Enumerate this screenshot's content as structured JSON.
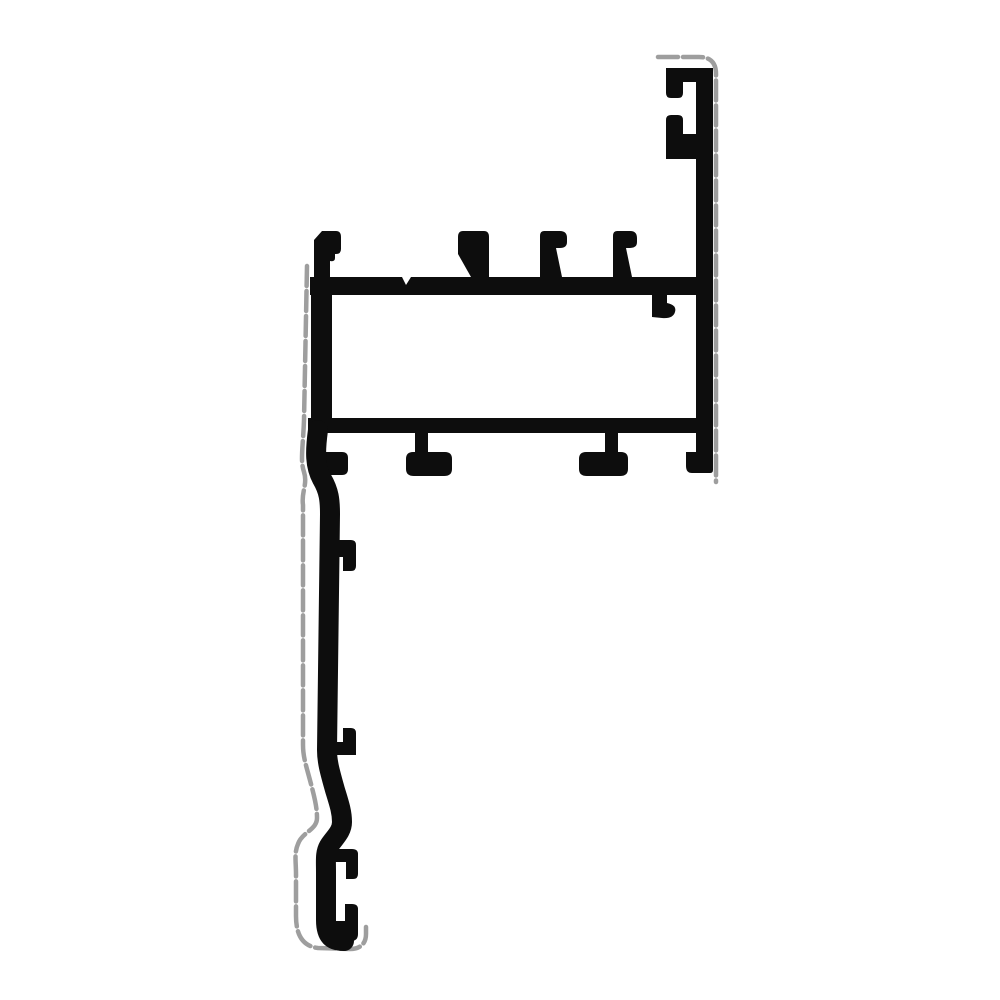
{
  "image": {
    "subject": "aluminium-extrusion-profile-cross-section",
    "width": 1000,
    "height": 1000
  },
  "colors": {
    "bg": "#ffffff",
    "ink": "#0d0d0d",
    "outline": "#9e9e9e"
  },
  "profile": {
    "parts": {
      "top_bar": "M310,277 H713 V295 H310 Z",
      "left_column": "M311,277 H332 V433 H311 Z",
      "bottom_bar": "M308,418 H710 V433 H308 Z",
      "right_column": "M696,68 H713 V470 Q713,473 710,473 H699 Q696,473 696,470 Z",
      "top_hook_upper": "M666,68 H713 V82 H683 V93 Q683,98 678,98 H671 Q666,98 666,93 Z",
      "top_hook_lower": "M671,115 L678,115 Q683,115 683,120 L683,134 L696,134 L696,159 L666,159 L666,120 Q666,115 671,115 Z",
      "tab_1": "M322,231 L336,231 Q341,231 341,237 L341,249 Q341,254 336,254 L335,254 L335,258 Q335,262 330,261 L330,277 L314,277 L314,240 Z",
      "tab_2": "M463,231 L484,231 Q489,231 489,237 L489,277 L471,277 L458,254 L458,237 Q458,231 463,231 Z",
      "tab_3": "M544,231 L560,231 Q567,231 567,238 L567,242 Q567,248 560,248 L556,248 L562,277 L540,277 L540,236 Q540,231 544,231 Z",
      "tab_4": "M617,231 L630,231 Q637,231 637,238 L637,242 Q637,248 630,248 L626,248 L632,277 L613,277 L613,236 Q613,231 617,231 Z",
      "under_bar_hook": "M652,295 L667,295 L667,303 Q677,305 675,312 Q673,319 662,318 L652,317 Z",
      "foot_1": "M310,452 H342 Q348,452 348,458 V469 Q348,475 342,475 H310 Z",
      "foot_2": "M415,433 H428 V455 H415 Z M413,452 H445 Q452,452 452,459 V469 Q452,476 444,476 H414 Q406,476 406,469 V459 Q406,452 413,452 Z",
      "foot_3": "M605,433 H618 V455 H605 Z M586,452 H621 Q628,452 628,459 V469 Q628,476 620,476 H587 Q579,476 579,469 V459 Q579,452 586,452 Z",
      "foot_4": "M686,452 H713 V466 Q713,473 706,473 H692 Q686,473 686,466 Z",
      "leg_hook_upper": "M332,540 L351,540 Q356,540 356,545 L356,566 Q356,571 351,571 L343,571 L343,557 L332,557 Z",
      "leg_hook_lower": "M343,728 L351,728 Q356,728 356,733 L356,755 L330,755 L330,742 L343,742 Z",
      "tail_hook_upper": "M332,849 L352,849 Q358,849 358,854 L358,874 Q358,879 353,879 L346,879 L346,862 L332,862 Z",
      "tail_hook_lower": "M332,921 L345,921 L345,904 L352,904 Q358,904 358,909 L358,934 Q358,941 351,941 L332,941 Z",
      "leg_centerline": "M318,430 C315,452 315,466 322,479 C329,491 330,500 330,514 L327,750 C327,762 330,772 335,790 C340,806 342,813 342,822 C342,832 334,838 329,846 C325,853 326,860 326,872 L326,920 C326,936 332,941 344,941",
      "bar_notch": "M402,277 L411,277 L406,285 Z"
    },
    "outlines": {
      "left": "M307,266 L304,420 C303,448 300,460 304,472 C308,484 301,492 303,505 L303,745 C303,757 306,765 311,784 C315,799 317,808 317,818 C317,830 302,832 298,844 C294,853 296,862 296,874 L296,916 C296,934 302,946 318,948 L350,949 C361,949 366,943 366,934 L366,927",
      "right": "M658,57 L699,57 Q716,57 716,74 L716,482"
    },
    "stroke": {
      "leg_width": 20,
      "outline_width": 4.5,
      "outline_dash": "20 5"
    }
  }
}
